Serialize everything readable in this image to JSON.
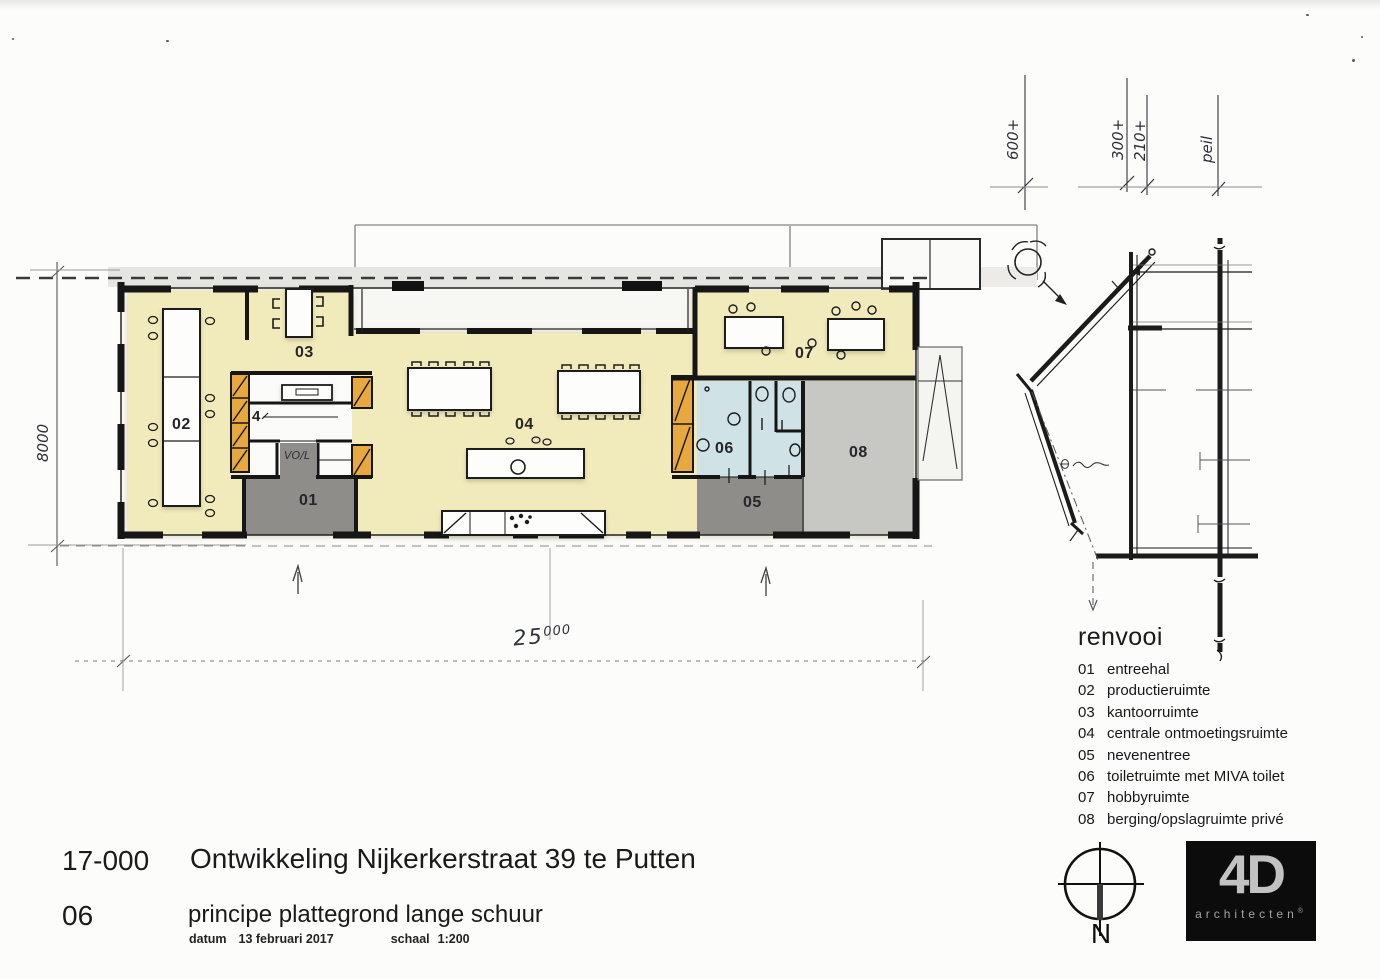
{
  "title_block": {
    "project_number": "17-000",
    "project_title": "Ontwikkeling Nijkerkerstraat 39 te Putten",
    "sheet_number": "06",
    "sheet_title": "principe plattegrond lange schuur",
    "datum_label": "datum",
    "datum_value": "13 februari 2017",
    "schaal_label": "schaal",
    "schaal_value": "1:200"
  },
  "legend": {
    "heading": "renvooi",
    "items": [
      {
        "num": "01",
        "label": "entreehal"
      },
      {
        "num": "02",
        "label": "productieruimte"
      },
      {
        "num": "03",
        "label": "kantoorruimte"
      },
      {
        "num": "04",
        "label": "centrale ontmoetingsruimte"
      },
      {
        "num": "05",
        "label": "nevenentree"
      },
      {
        "num": "06",
        "label": "toiletruimte met MIVA toilet"
      },
      {
        "num": "07",
        "label": "hobbyruimte"
      },
      {
        "num": "08",
        "label": "berging/opslagruimte privé"
      }
    ]
  },
  "plan": {
    "rooms": {
      "r01": "01",
      "r02": "02",
      "r03": "03",
      "r04": "04",
      "r05": "05",
      "r06": "06",
      "r07": "07",
      "r08": "08"
    },
    "core_number": "4",
    "core_note": "VO/L",
    "dim_left": "8000",
    "dim_bottom_main": "25",
    "dim_bottom_sup": "000"
  },
  "levels": {
    "l600": "600+",
    "l300": "300+",
    "l210": "210+",
    "peil": "peil"
  },
  "north": {
    "label": "N"
  },
  "logo": {
    "brand": "4D",
    "sub": "architecten",
    "reg": "®"
  },
  "colors": {
    "floor_yellow": "#f1ebbb",
    "cabinet_orange": "#e7a93f",
    "toilet_blue": "#cfe2e5",
    "storage_gray": "#c7c7c4",
    "entry_gray": "#8f8d8a",
    "wall_black": "#161616"
  }
}
